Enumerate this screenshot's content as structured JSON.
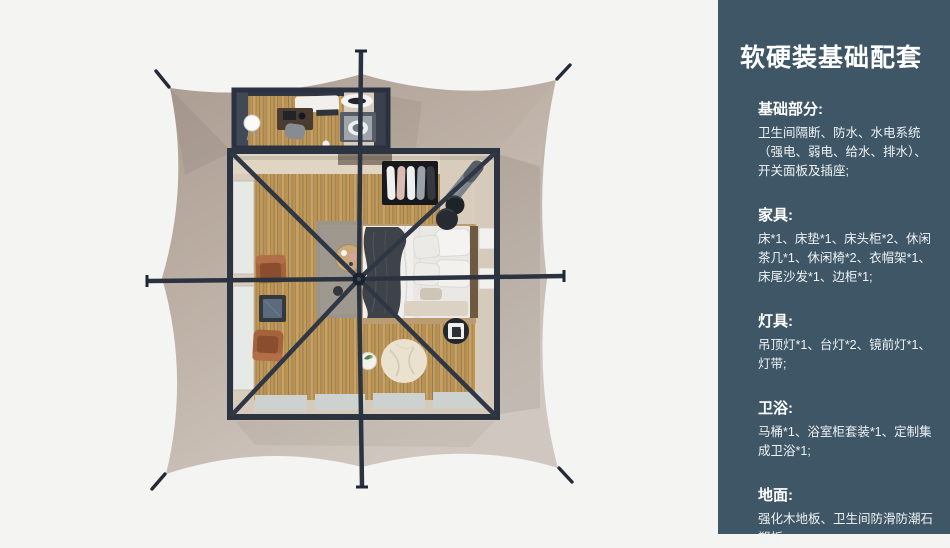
{
  "panel": {
    "title": "软硬装基础配套",
    "bg_color": "#3e5666",
    "text_color": "#ffffff",
    "sections": [
      {
        "heading": "基础部分:",
        "body": "卫生间隔断、防水、水电系统\n（强电、弱电、给水、排水）、\n开关面板及插座;"
      },
      {
        "heading": "家具:",
        "body": "床*1、床垫*1、床头柜*2、休闲\n茶几*1、休闲椅*2、衣帽架*1、\n床尾沙发*1、边柜*1;"
      },
      {
        "heading": "灯具:",
        "body": "吊顶灯*1、台灯*2、镜前灯*1、\n灯带;"
      },
      {
        "heading": "卫浴:",
        "body": "马桶*1、浴室柜套装*1、定制集\n成卫浴*1;"
      },
      {
        "heading": "地面:",
        "body": "强化木地板、卫生间防滑防潮石\n塑板;"
      }
    ]
  },
  "illustration": {
    "type": "tent-floorplan-top-view",
    "canvas_color": "#bcafa4",
    "frame_color": "#2c3341",
    "wood_floor_color": "#c59b58",
    "background_color": "#f4f4f3",
    "items": [
      "tent-canvas",
      "ridge-poles",
      "guy-line-stakes",
      "bathroom-annex",
      "vanity-counter",
      "toilet",
      "shower",
      "makeup-desk",
      "standing-mirror",
      "main-room",
      "clothes-rack",
      "bed",
      "pillows",
      "throw-blanket",
      "nightstands",
      "stools",
      "tray-side-table",
      "bean-bag",
      "plant-table",
      "coffee-table",
      "lounge-chairs",
      "glass-side-table",
      "rug",
      "windows"
    ]
  }
}
